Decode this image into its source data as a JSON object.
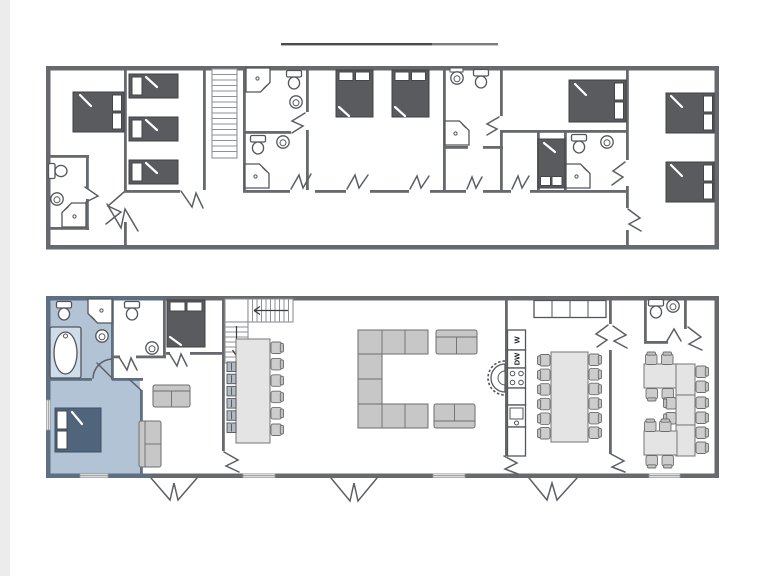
{
  "labels": {
    "washer": "W",
    "dishwasher": "DW"
  },
  "colors": {
    "background": "#ffffff",
    "left_margin_strip": "#ececec",
    "divider_dark": "#4c4c4c",
    "divider_light": "#7d7d7d",
    "wall": "#66696e",
    "wall_highlight": "#5f6f82",
    "highlight_floor": "#b2c3d6",
    "bed_dark": "#595b5e",
    "bed_highlight": "#50657c",
    "furniture_fill": "#c7c7c7",
    "table_fill": "#e4e4e4"
  }
}
